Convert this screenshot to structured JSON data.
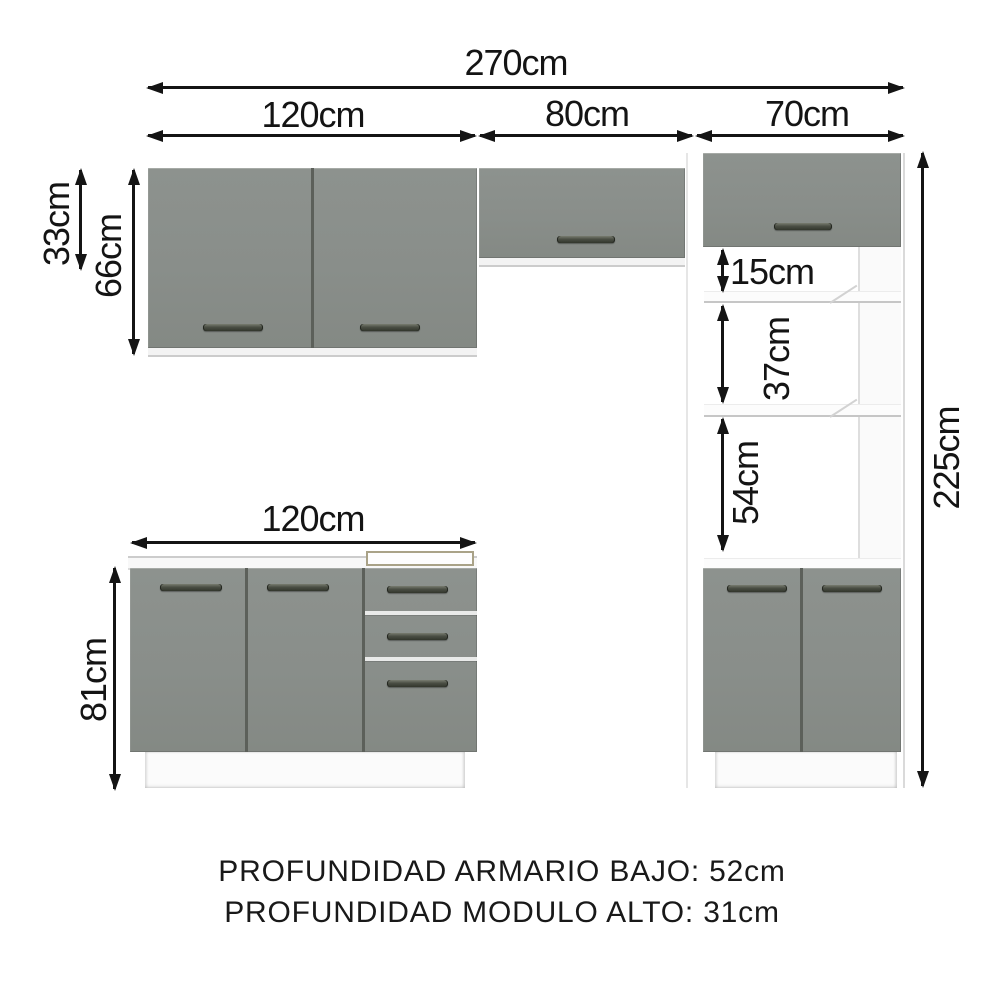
{
  "diagram": {
    "type": "kitchen-cabinet-dimension-drawing",
    "dims": {
      "total_width": "270cm",
      "upper_left_width": "120cm",
      "upper_mid_width": "80cm",
      "upper_right_width": "70cm",
      "upper_mid_height": "33cm",
      "upper_left_height": "66cm",
      "tall_niche_top": "15cm",
      "tall_niche_middle": "37cm",
      "tall_niche_bottom": "54cm",
      "total_height": "225cm",
      "base_width": "120cm",
      "base_height": "81cm"
    },
    "notes": {
      "depth_base": "PROFUNDIDAD ARMARIO BAJO: 52cm",
      "depth_tall": "PROFUNDIDAD MODULO ALTO: 31cm"
    },
    "colors": {
      "door_gray": "#898e8a",
      "handle_dark": "#3c4036",
      "carcass_white": "#ffffff",
      "dimension_line": "#141414",
      "sink_rim": "#a9a287"
    }
  }
}
